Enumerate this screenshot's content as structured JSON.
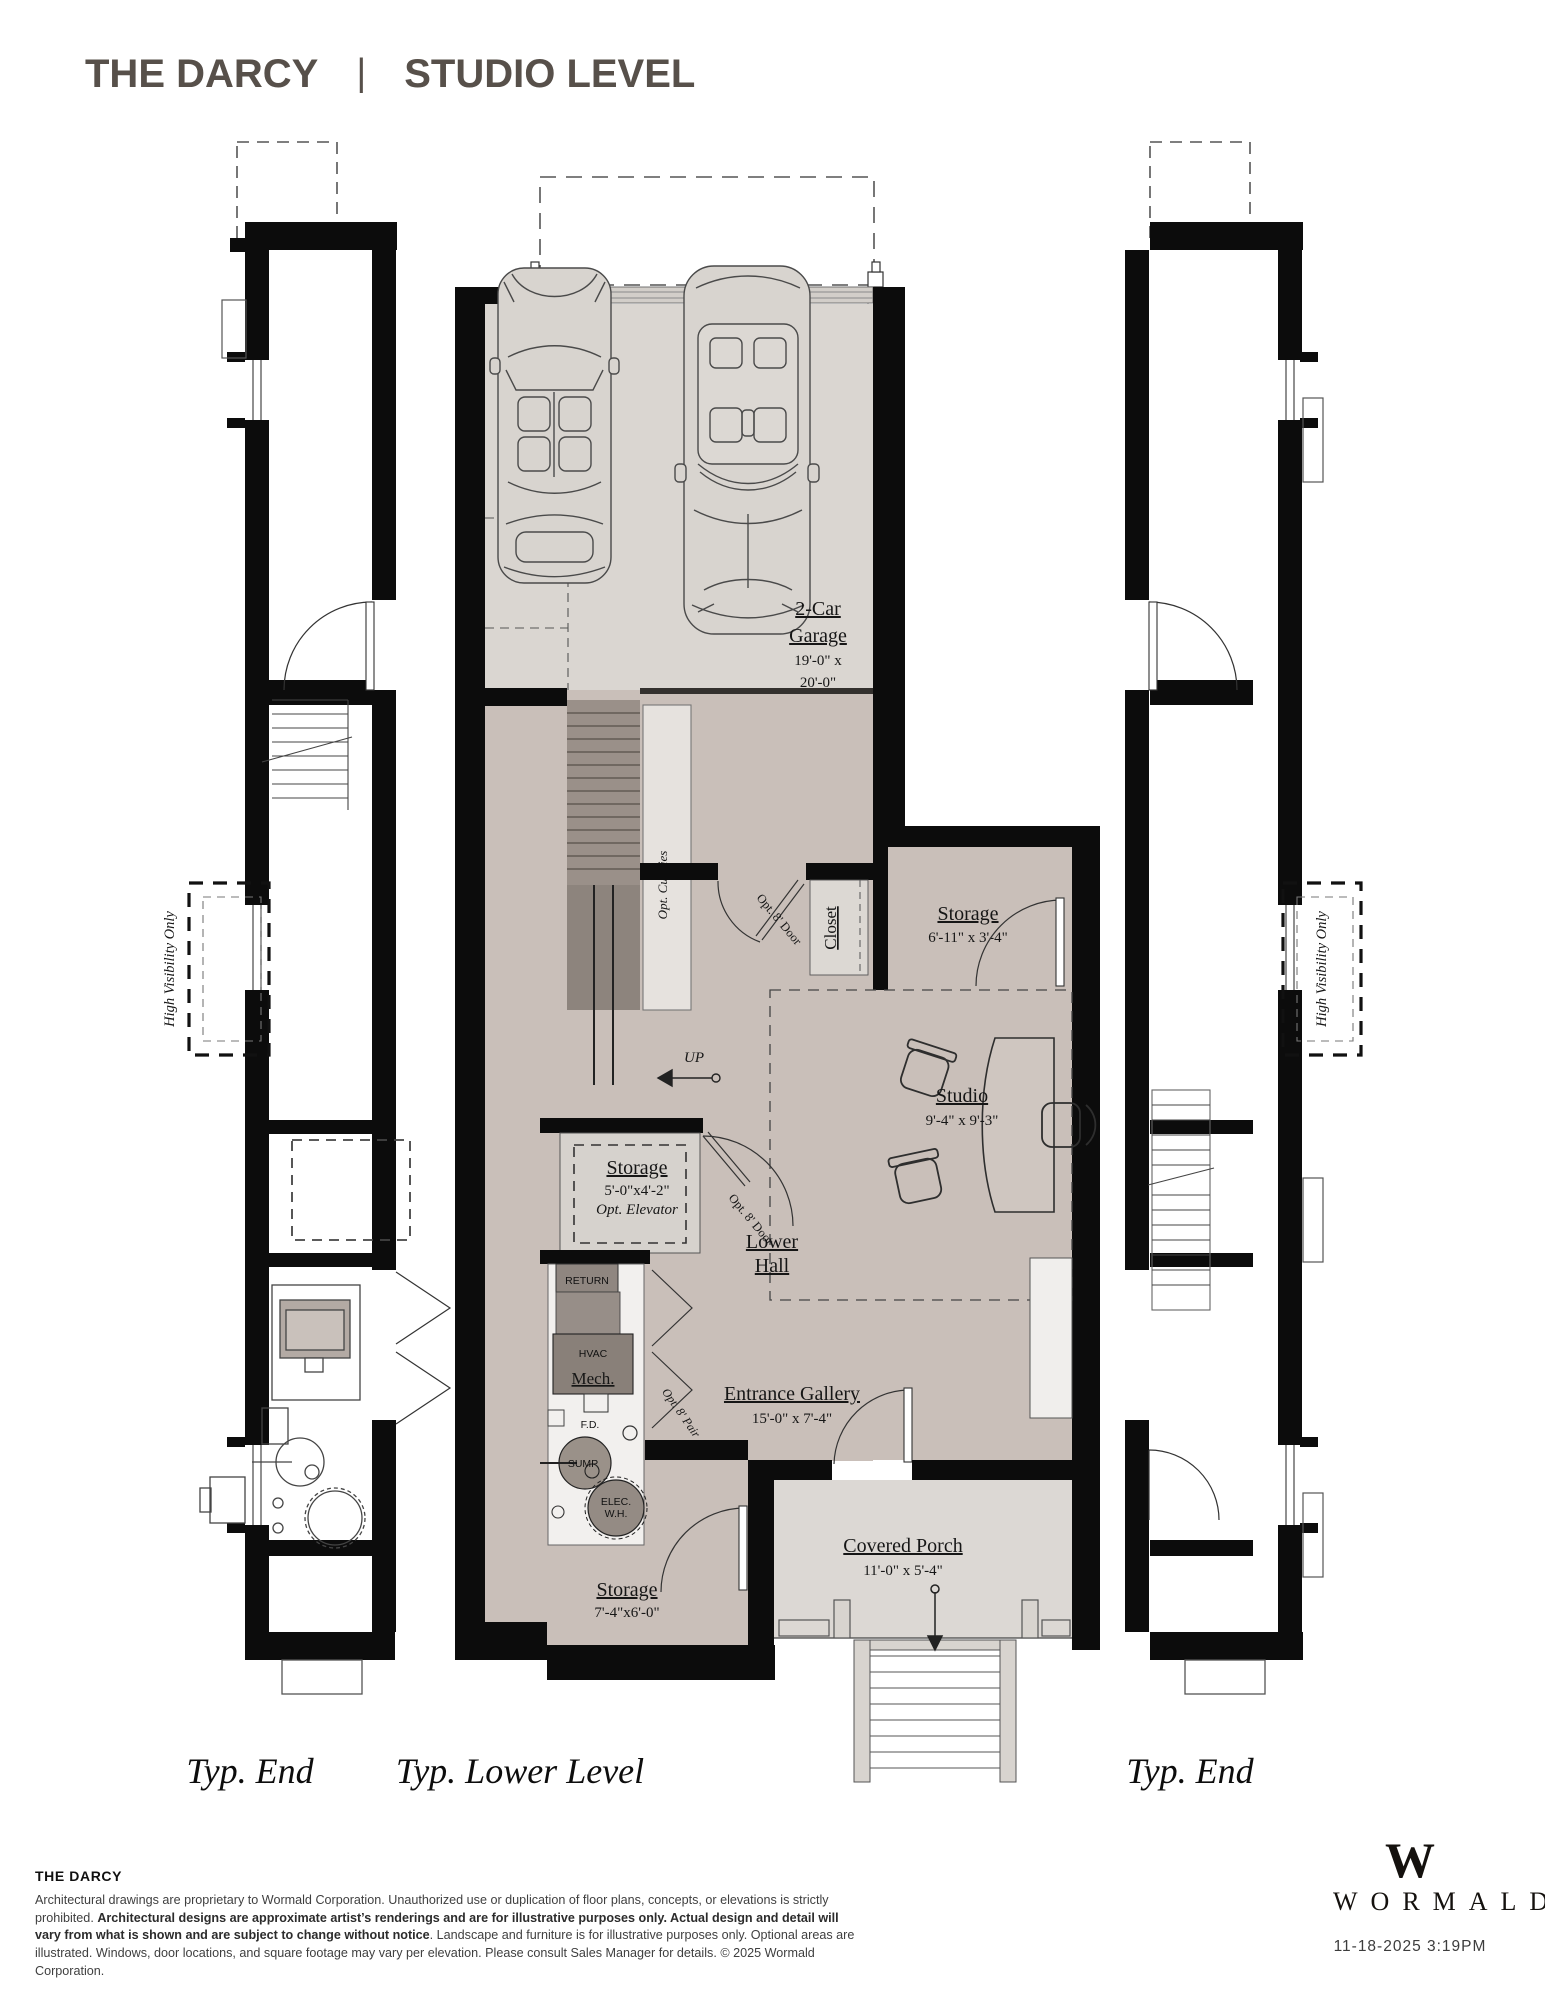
{
  "title": {
    "name": "THE DARCY",
    "separator": "|",
    "level": "STUDIO LEVEL"
  },
  "plan": {
    "garage": {
      "label1": "2-Car",
      "label2": "Garage",
      "dims1": "19'-0\" x",
      "dims2": "20'-0\""
    },
    "storage_upper": {
      "label": "Storage",
      "dims": "6'-11\" x 3'-4\""
    },
    "closet": {
      "label": "Closet"
    },
    "studio": {
      "label": "Studio",
      "dims": "9'-4\" x 9'-3\""
    },
    "storage_mid": {
      "label": "Storage",
      "dims": "5'-0\"x4'-2\"",
      "note": "Opt. Elevator"
    },
    "lower_hall": {
      "label1": "Lower",
      "label2": "Hall"
    },
    "mech": {
      "label": "Mech.",
      "hvac": "HVAC",
      "return_label": "RETURN",
      "fd": "F.D.",
      "sump": "SUMP",
      "wh1": "ELEC.",
      "wh2": "W.H."
    },
    "entrance_gallery": {
      "label": "Entrance Gallery",
      "dims": "15'-0\" x 7'-4\""
    },
    "covered_porch": {
      "label": "Covered Porch",
      "dims": "11'-0\" x 5'-4\""
    },
    "storage_lower": {
      "label": "Storage",
      "dims": "7'-4\"x6'-0\""
    },
    "annotations": {
      "opt_cubbies": "Opt. Cubbies",
      "up": "UP",
      "opt_door_upper": "Opt. 8' Door",
      "opt_door_mid": "Opt. 8' Door",
      "opt_pair": "Opt. 8' Pair",
      "high_visibility_left": "High Visibility Only",
      "high_visibility_right": "High Visibility Only"
    },
    "sections": {
      "left": "Typ. End",
      "center": "Typ. Lower Level",
      "right": "Typ. End"
    }
  },
  "footer": {
    "plan_name": "THE DARCY",
    "disclaimer_normal_1": "Architectural drawings are proprietary to Wormald Corporation. Unauthorized use or duplication of floor plans, concepts, or elevations is strictly prohibited. ",
    "disclaimer_bold": "Architectural designs are approximate artist’s renderings and are for illustrative purposes only. Actual design and detail will vary from what is shown and are subject to change without notice",
    "disclaimer_normal_2": ". Landscape and furniture is for illustrative purposes only. Optional areas are illustrated. Windows, door locations, and square footage may vary per elevation. Please consult Sales Manager for details. © 2025 Wormald Corporation.",
    "brand": {
      "initial": "W",
      "name": "WORMALD"
    },
    "timestamp": "11-18-2025 3:19PM"
  },
  "colors": {
    "brand_title": "#57504a",
    "garage_floor": "#dad6d1",
    "studio_floor": "#c9bfb9",
    "stair_dark": "#9a9089",
    "equipment_gray": "#8f8680",
    "porch": "#dcd8d4",
    "wall": "#0c0c0c"
  }
}
